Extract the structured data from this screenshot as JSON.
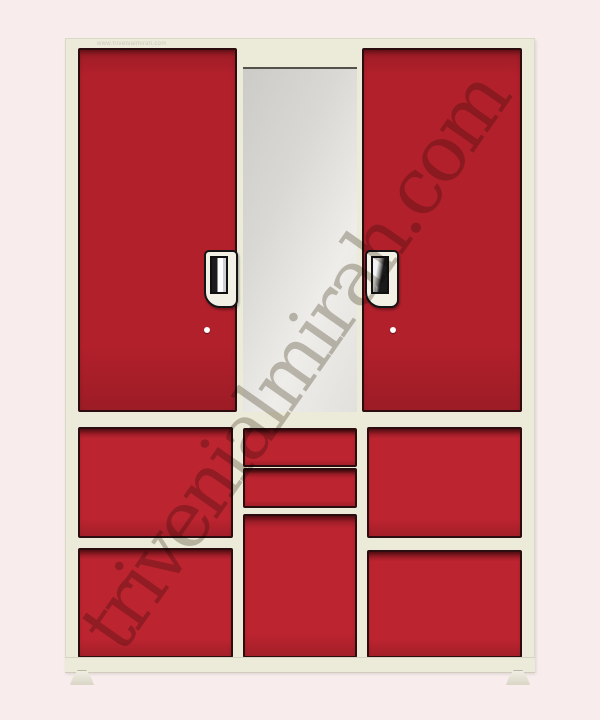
{
  "watermarks": {
    "diagonal_text": "trivenialmirah.com",
    "top_url_text": "www.trivenialmirah.com"
  },
  "colors": {
    "background": "#f8edec",
    "frame_cream": "#ecead9",
    "door_red": "#b2202b",
    "door_red_dark": "#9c1c26",
    "panel_red": "#bc2430",
    "edge_dark": "#2b0d10",
    "mirror_light": "#eeede9",
    "mirror_dark": "#cccbc7",
    "handle_plate": "#f3f0e5",
    "lock_white": "#ffffff",
    "watermark_gray": "#c6c2ba"
  }
}
